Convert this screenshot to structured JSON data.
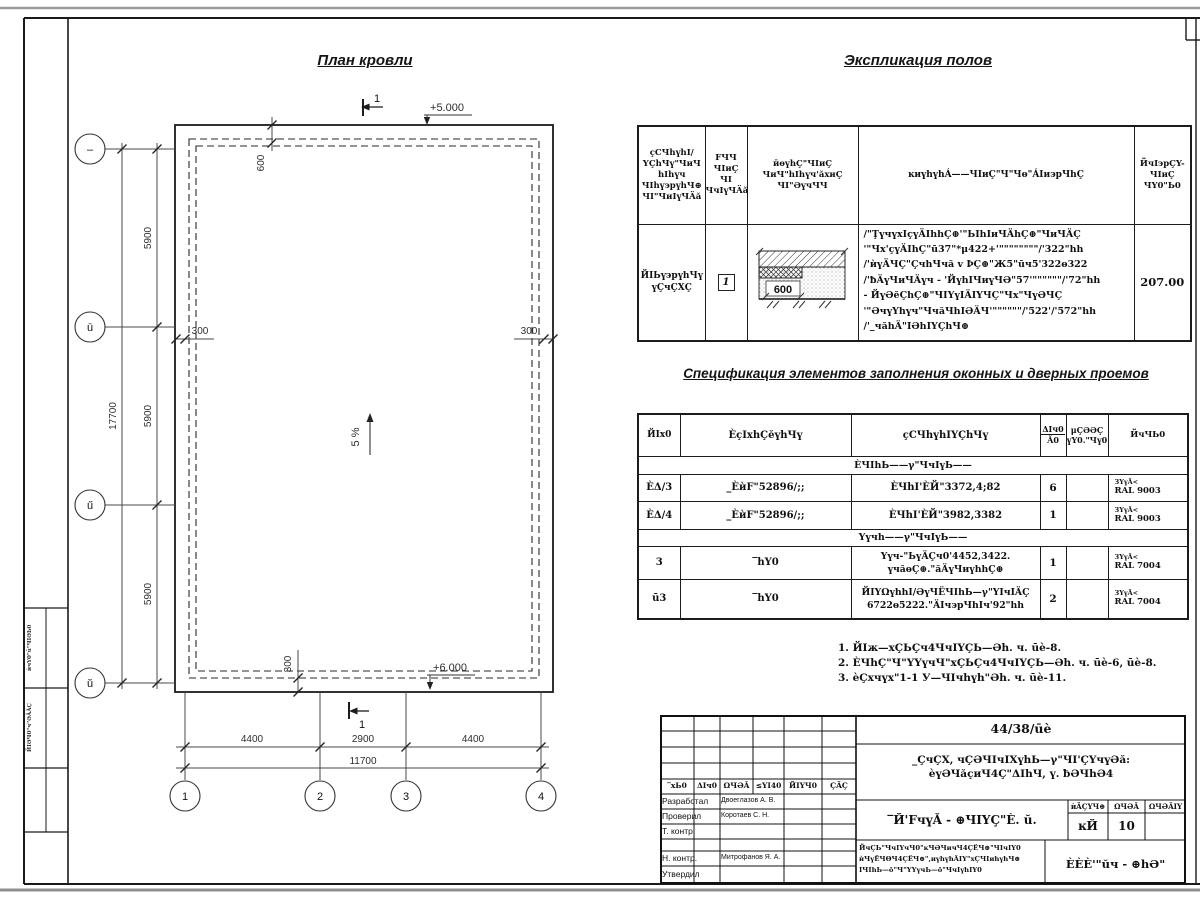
{
  "plan": {
    "title": "План кровли",
    "axes_left": [
      "–",
      "ū",
      "ű",
      "ŭ"
    ],
    "axes_bottom": [
      "1",
      "2",
      "3",
      "4"
    ],
    "dim_v_total": "17700",
    "dim_v": [
      "5900",
      "5900",
      "5900"
    ],
    "dim_h": [
      "4400",
      "2900",
      "4400"
    ],
    "dim_h_total": "11700",
    "dim_600": "600",
    "dim_300_left": "300",
    "dim_300_right": "300",
    "dim_300_bottom": "300",
    "level_top": "+5.000",
    "level_bottom": "+6.000",
    "slope": "5 %",
    "section_top": "1",
    "section_bottom": "1"
  },
  "explication": {
    "title": "Экспликация полов",
    "col1": "ҫСЧhүhI/\nYҪhЧү\"ЧиЧ\nhIhүч\nЧIhү϶рүhЧ⊕\nЧI\"ЧиIүЧÄă",
    "col2": "FЧЧ\nЧIиҪ\nЧI\nЧчIүЧÄă",
    "col3": "ӣɵүhҪ\"ЧIиҪ\nЧиЧ\"hIhүч'ăхиҪ\nЧI\"ƏүчЧЧ",
    "col4": "ĸиүhүhÁ——ЧIиҪ\"Ч\"Чɵ\"ÁIи϶рЧhҪ",
    "col5": "ЙчI϶рҪY-\nЧIиҪ\nЧY0\"Ь0",
    "row_name": "ЙIЬү϶рүhЧү\nүҪчҪХҪ",
    "row_num": "1",
    "detail_dim": "600",
    "row_desc": "/\"ŢүчүхIçүÄIhhҪ⊕'\"ЬIhIиЧÄhҪ⊕\"ЧиЧÄҪ\n'\"Чх'çүÄIhҪ\"ū37\"*μ422+'\"\"\"\"\"\"\"\"/'322\"hh\n/'ѝүÄЧҪ\"ҪчhЧчă v ϷҪ⊕\"Ж5\"ūч5'322ɵ322\n/'ƀÄүЧиЧÄүч - 'ЙүhIЧиүЧƏ\"57'\"\"\"\"\"\"/'72\"hh\n- ЙүƏĕҪhҪ⊕\"ЧIYүIÄIYЧҪ\"Чх\"ЧүƏЧҪ\n'\"ƏчүҮhүч\"ЧчăЧhIƏÄЧ'\"\"\"\"\"\"/'522'/'572\"hh\n/'_чăhÄ\"IƏhIYҪhЧ⊕",
    "row_area": "207.00"
  },
  "specification": {
    "title": "Спецификация элементов заполнения оконных и дверных проемов",
    "h1": "ЙIх0",
    "h2": "ÈçIхhҪĕүhЧү",
    "h3": "ҫСЧhүhIYҪhЧү",
    "h4_top": "ΔIч0",
    "h4_bot": "Ă0",
    "h5": "μҪƏƏҪ\nүY0.\"Чү0",
    "h6": "ЙчЧЬ0",
    "section1": "ÈЧIhЬ——γ\"ЧчIүЬ——",
    "section2": "Yүчh——γ\"ЧчIүЬ——",
    "rows": [
      {
        "mark": "ÈΔ/3",
        "desig": "_ÈѝF\"52896/;;",
        "name": "ÈЧhI'ÈЙ\"3372,4;82",
        "qty": "6",
        "mass": "",
        "note1": "ЗYүÄ<",
        "note2": "RAL 9003"
      },
      {
        "mark": "ÈΔ/4",
        "desig": "_ÈѝF\"52896/;;",
        "name": "ÈЧhI'ÈЙ\"3982,3382",
        "qty": "1",
        "mass": "",
        "note1": "ЗYүÄ<",
        "note2": "RAL 9003"
      },
      {
        "mark": "3",
        "desig": "‾hY0",
        "name": "Yүч-\"ЬүÄҪч0'4452,3422.\nүчăɵҪ⊕.\"ăÄүЧиүhhҪ⊕",
        "qty": "1",
        "mass": "",
        "note1": "ЗYүÄ<",
        "note2": "RAL 7004"
      },
      {
        "mark": "ū3",
        "desig": "‾hY0",
        "name": "ЙIYΩүhhI/ƏүЧЁЧIhЬ—γ\"YIчIÄҪ\n6722ɵ5222.\"ÄIч϶рЧhIч'92\"hh",
        "qty": "2",
        "mass": "",
        "note1": "ЗYүÄ<",
        "note2": "RAL 7004"
      }
    ]
  },
  "notes": [
    "1. ЙIж—хҪЬҪч4ЧчIYҪЬ—Əh. ч. ūè-8.",
    "2. ÈЧhҪ\"Ч\"YYүчЧ\"хҪЬҪч4ЧчIYҪЬ—Əh. ч. ūè-6, ūè-8.",
    "3. èҪхчүх\"1-1 У—ЧIчhүh\"Əh. ч. ūè-11."
  ],
  "stamp": {
    "doc_number": "44/38/ūè",
    "object": "_ҪчҪХ, чҪƏЧIчIХүhЬ—γ\"ЧI'ҪYчүƏă:\nèүƏЧăçиЧ4Ҫ\"ΔIhЧ, ү. ƀƏЧhƏ4",
    "cols": [
      "‾хЬ0",
      "ΔIч0",
      "ΩЧƏĂ",
      "≤YI40",
      "ЙIYЧ0",
      "ҪÄҪ"
    ],
    "roles": [
      "Разработал",
      "Проверил",
      "Т. контр.",
      "Н. контр.",
      "Утвердил"
    ],
    "names": [
      "Двоеглазов А. В.",
      "Коротаев С. Н.",
      "Митрофанов Я. А."
    ],
    "sheet_title": "‾Й'FчүĂ - ⊕ЧIYҪ\"È. ŭ.",
    "stage_cols": [
      "ѝÄҪYЧ⊕",
      "ΩЧƏĂ",
      "ΩЧƏĂIY"
    ],
    "stage": "ĸЙ",
    "sheet_no": "10",
    "sheets_total": "",
    "small_text": "ЙчҪЬ\"ЧчIYчЧ0\"ĸЧƏЧичЧ4ҪЁЧ⊕\"ЧIчIY0\nѝЧүЁЧΘЧ4ҪЁЧ⊕\",иүhүhÄIY\"хҪЧIиhүhЧ⊕\nIЧIhЬ—ō\"Ч\"YYүчЬ—ō\"ЧчIүhIY0",
    "company": "ÈÈÈ'\"ŭч - ⊕hƏ\""
  },
  "strip": {
    "label1": "ѝчY0\"ū\"ЧIƏЬ0",
    "label2": "ЙIƏЧ0\"ч\"ƏÄĂҪ"
  }
}
